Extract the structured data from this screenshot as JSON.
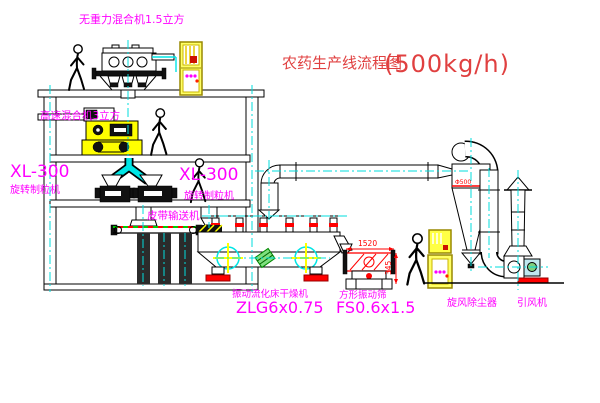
{
  "title": {
    "cn": "农药生产线流程图",
    "capacity": "(500kg/h)"
  },
  "labels": {
    "gravity_mixer": "无重力混合机1.5立方",
    "high_speed_mixer": "高速混合机3立方",
    "granulator_left_model": "XL-300",
    "granulator_left_name": "旋转制粒机",
    "granulator_mid_model": "XL-300",
    "granulator_mid_name": "旋转制粒机",
    "belt_conveyor": "皮带输送机",
    "dryer_name": "振动流化床干燥机",
    "dryer_model": "ZLG6x0.75",
    "sieve_name": "方形振动筛",
    "sieve_model": "FS0.6x1.5",
    "cyclone": "旋风除尘器",
    "fan": "引风机"
  },
  "dimensions": {
    "sieve_length": "1520",
    "sieve_height": "345",
    "cyclone_dia": "Φ500"
  },
  "colors": {
    "label": "#ff00ff",
    "title": "#e04040",
    "dimension": "#ff0000",
    "centerline": "#00dddd",
    "machine": "#ffff00"
  }
}
